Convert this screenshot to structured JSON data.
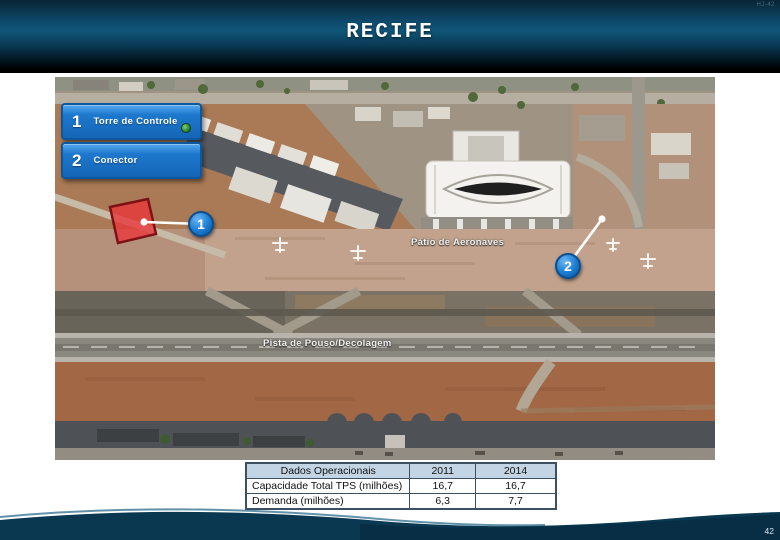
{
  "slide": {
    "title": "RECIFE",
    "page_number": "42",
    "corner_mark": "HJ-42"
  },
  "legend": {
    "items": [
      {
        "number": "1",
        "label": "Torre de Controle"
      },
      {
        "number": "2",
        "label": "Conector"
      }
    ]
  },
  "map": {
    "labels": {
      "apron": "Pátio de Aeronaves",
      "runway": "Pista de Pouso/Decolagem"
    },
    "markers": [
      {
        "number": "1"
      },
      {
        "number": "2"
      }
    ]
  },
  "table": {
    "header": [
      "Dados Operacionais",
      "2011",
      "2014"
    ],
    "rows": [
      [
        "Capacidade Total TPS (milhões)",
        "16,7",
        "16,7"
      ],
      [
        "Demanda (milhões)",
        "6,3",
        "7,7"
      ]
    ]
  },
  "colors": {
    "accent_blue": "#1d78cd",
    "legend_border": "#0b57a0",
    "marker_blue": "#1b7cd0",
    "highlight_red": "#ea343a",
    "table_header_bg": "#c3d4e4",
    "footer_navy": "#0a3850",
    "header_teal": "#0f5578"
  }
}
